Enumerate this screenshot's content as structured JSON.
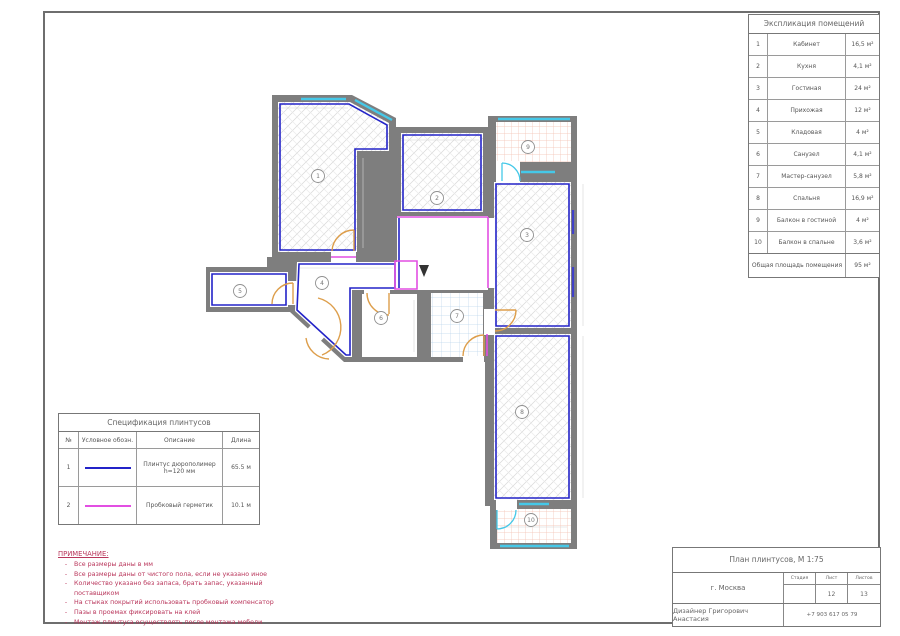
{
  "explication": {
    "title": "Экспликация помещений",
    "rows": [
      {
        "num": "1",
        "name": "Кабинет",
        "area": "16,5 м²"
      },
      {
        "num": "2",
        "name": "Кухня",
        "area": "4,1 м²"
      },
      {
        "num": "3",
        "name": "Гостиная",
        "area": "24 м²"
      },
      {
        "num": "4",
        "name": "Прихожая",
        "area": "12 м²"
      },
      {
        "num": "5",
        "name": "Кладовая",
        "area": "4 м²"
      },
      {
        "num": "6",
        "name": "Санузел",
        "area": "4,1 м²"
      },
      {
        "num": "7",
        "name": "Мастер-санузел",
        "area": "5,8 м²"
      },
      {
        "num": "8",
        "name": "Спальня",
        "area": "16,9 м²"
      },
      {
        "num": "9",
        "name": "Балкон в гостиной",
        "area": "4 м²"
      },
      {
        "num": "10",
        "name": "Балкон в спальне",
        "area": "3,6 м²"
      }
    ],
    "total_label": "Общая площадь помещения",
    "total_value": "95 м²"
  },
  "specification": {
    "title": "Спецификация плинтусов",
    "columns": [
      "№",
      "Условное обозн.",
      "Описание",
      "Длина"
    ],
    "rows": [
      {
        "num": "1",
        "swatch": "#2323c8",
        "desc": "Плинтус дюрополимер h=120 мм",
        "len": "65.5 м"
      },
      {
        "num": "2",
        "swatch": "#e24fe2",
        "desc": "Пробковый герметик",
        "len": "10.1 м"
      }
    ]
  },
  "notes": {
    "title": "ПРИМЕЧАНИЕ:",
    "items": [
      "Все размеры даны в мм",
      "Все размеры даны от чистого пола, если не указано иное",
      "Количество указано без запаса, брать запас, указанный поставщиком",
      "На стыках покрытий использовать пробковый компенсатор",
      "Пазы в проемах фиксировать на клей",
      "Монтаж плинтуса осуществлять после монтажа мебели"
    ]
  },
  "titleblock": {
    "title": "План плинтусов, М 1:75",
    "city": "г. Москва",
    "stage_label": "Стадия",
    "sheet_label": "Лист",
    "sheets_label": "Листов",
    "stage": "",
    "sheet": "12",
    "sheets": "13",
    "designer": "Дизайнер Григорович Анастасия",
    "phone": "+7 903 617 05 79"
  },
  "plan": {
    "room_labels": [
      {
        "n": "1",
        "x": 318,
        "y": 176
      },
      {
        "n": "2",
        "x": 437,
        "y": 198
      },
      {
        "n": "3",
        "x": 527,
        "y": 235
      },
      {
        "n": "4",
        "x": 322,
        "y": 283
      },
      {
        "n": "5",
        "x": 240,
        "y": 291
      },
      {
        "n": "6",
        "x": 381,
        "y": 318
      },
      {
        "n": "7",
        "x": 457,
        "y": 316
      },
      {
        "n": "8",
        "x": 522,
        "y": 412
      },
      {
        "n": "9",
        "x": 528,
        "y": 147
      },
      {
        "n": "10",
        "x": 531,
        "y": 520
      }
    ]
  },
  "colors": {
    "wall_gray": "#7e7e7e",
    "skirting_blue": "#2323c8",
    "sealant_magenta": "#e24fe2",
    "window_cyan": "#45c8e8",
    "door_orange": "#dd9e4b",
    "notes_red": "#b9365b"
  }
}
